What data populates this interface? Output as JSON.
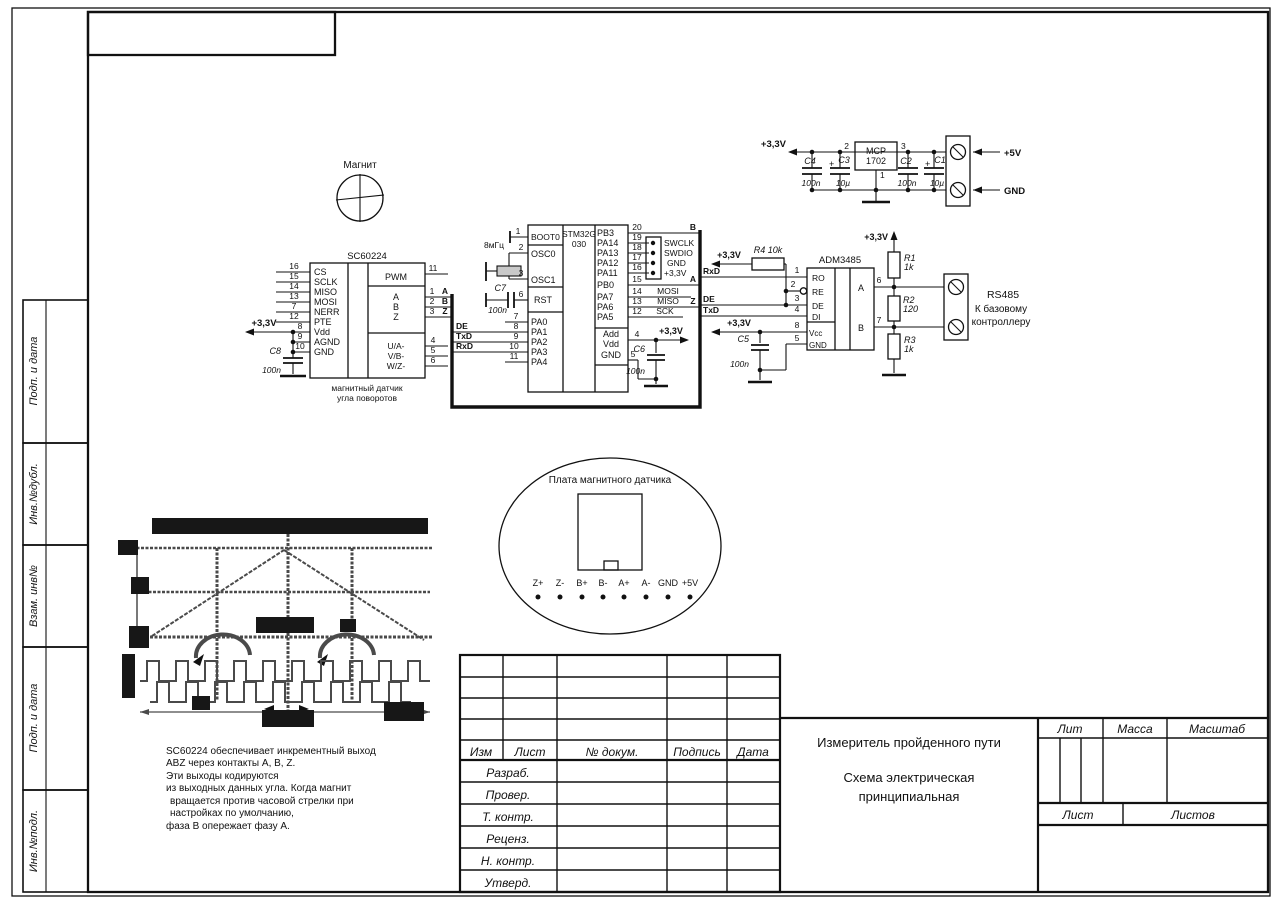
{
  "sheet": {
    "margin_labels": [
      "Подп. и дата",
      "Инв.№дубл.",
      "Взам. инв№",
      "Подп. и дата",
      "Инв.№подл."
    ]
  },
  "power": {
    "v33": "+3,3V",
    "c4": "C4",
    "c4_val": "100n",
    "c3": "C3",
    "c3_plus": "+",
    "c3_val": "10µ",
    "reg_line1": "MCP",
    "reg_line2": "1702",
    "pin2": "2",
    "pin3": "3",
    "pin1": "1",
    "c2": "C2",
    "c2_val": "100n",
    "c1": "C1",
    "c1_plus": "+",
    "c1_val": "10µ",
    "v5": "+5V",
    "gnd": "GND"
  },
  "magnet": {
    "label": "Магнит"
  },
  "sc": {
    "title": "SC60224",
    "left_pins": [
      {
        "n": "16",
        "t": "CS"
      },
      {
        "n": "15",
        "t": "SCLK"
      },
      {
        "n": "14",
        "t": "MISO"
      },
      {
        "n": "13",
        "t": "MOSI"
      },
      {
        "n": "7",
        "t": "NERR"
      },
      {
        "n": "12",
        "t": "PTE"
      },
      {
        "n": "8",
        "t": "Vdd"
      },
      {
        "n": "9",
        "t": "AGND"
      },
      {
        "n": "10",
        "t": "GND"
      }
    ],
    "right_pins": [
      {
        "n": "11",
        "t": "PWM"
      },
      {
        "n": "1",
        "t": "A"
      },
      {
        "n": "2",
        "t": "B"
      },
      {
        "n": "3",
        "t": "Z"
      },
      {
        "n": "4",
        "t": "U/A-"
      },
      {
        "n": "5",
        "t": "V/B-"
      },
      {
        "n": "6",
        "t": "W/Z-"
      }
    ],
    "v33": "+3,3V",
    "c8": "C8",
    "c8_val": "100n",
    "caption1": "магнитный датчик",
    "caption2": "угла поворотов"
  },
  "mcu": {
    "in_a": "A",
    "in_b": "B",
    "in_z": "Z",
    "de": "DE",
    "txd": "TxD",
    "rxd": "RxD",
    "xtal": "8мГц",
    "c7": "C7",
    "c7_val": "100n",
    "name1": "STM32G",
    "name2": "030",
    "left_pins": [
      {
        "n": "1",
        "t": "BOOT0"
      },
      {
        "n": "2",
        "t": "OSC0"
      },
      {
        "n": "3",
        "t": "OSC1"
      },
      {
        "n": "6",
        "t": "RST"
      },
      {
        "n": "7",
        "t": "PA0"
      },
      {
        "n": "8",
        "t": "PA1"
      },
      {
        "n": "9",
        "t": "PA2"
      },
      {
        "n": "10",
        "t": "PA3"
      },
      {
        "n": "11",
        "t": "PA4"
      }
    ],
    "right_pins": [
      {
        "n": "20",
        "t": "PB3"
      },
      {
        "n": "19",
        "t": "PA14"
      },
      {
        "n": "18",
        "t": "PA13"
      },
      {
        "n": "17",
        "t": "PA12"
      },
      {
        "n": "16",
        "t": "PA11"
      },
      {
        "n": "15",
        "t": "PB0"
      },
      {
        "n": "14",
        "t": "PA7"
      },
      {
        "n": "13",
        "t": "PA6"
      },
      {
        "n": "12",
        "t": "PA5"
      }
    ],
    "swd": [
      "SWCLK",
      "SWDIO",
      "GND",
      "+3,3V"
    ],
    "mosi": "MOSI",
    "miso": "MISO",
    "sck": "SCK",
    "out_b": "B",
    "out_a": "A",
    "out_z": "Z",
    "pwr_pins": [
      "Add",
      "Vdd",
      "GND"
    ],
    "pin4": "4",
    "pin5": "5",
    "v33": "+3,3V",
    "c6": "C6",
    "c6_val": "100n",
    "out_rxd": "RxD",
    "out_de": "DE",
    "out_txd": "TxD"
  },
  "adm": {
    "title": "ADM3485",
    "r4": "R4 10k",
    "v33_r4": "+3,3V",
    "pin_nums_left": [
      "1",
      "2",
      "3",
      "4"
    ],
    "pin_names_left": [
      "RO",
      "RE",
      "DE",
      "DI"
    ],
    "vcc": "Vcc",
    "gnd": "GND",
    "pin8": "8",
    "pin5": "5",
    "a": "A",
    "b": "B",
    "pin6": "6",
    "pin7": "7",
    "v33_vcc": "+3,3V",
    "c5": "C5",
    "c5_val": "100n",
    "v33_r1": "+3,3V",
    "r1": "R1",
    "r1_val": "1k",
    "r2": "R2",
    "r2_val": "120",
    "r3": "R3",
    "r3_val": "1k",
    "rs485": "RS485",
    "dest1": "К базовому",
    "dest2": "контроллеру"
  },
  "sensor_board": {
    "title": "Плата магнитного датчика",
    "pins": [
      "Z+",
      "Z-",
      "B+",
      "B-",
      "A+",
      "A-",
      "GND",
      "+5V"
    ]
  },
  "note": {
    "line1": "SC60224 обеспечивает инкрементный выход",
    "line2": "ABZ через контакты A, B, Z.",
    "line3": "Эти выходы кодируются",
    "line4": "из выходных данных угла. Когда магнит",
    "line5": "вращается против часовой стрелки при",
    "line6": "настройках по умолчанию,",
    "line7": "фаза B опережает фазу A."
  },
  "title_block": {
    "col_izm": "Изм",
    "col_list": "Лист",
    "col_dokum": "№ докум.",
    "col_podpis": "Подпись",
    "col_data": "Дата",
    "row1": "Разраб.",
    "row2": "Провер.",
    "row3": "Т. контр.",
    "row4": "Реценз.",
    "row5": "Н. контр.",
    "row6": "Утверд.",
    "doc_title": "Измеритель пройденного пути",
    "doc_type1": "Схема электрическая",
    "doc_type2": "принципиальная",
    "lit": "Лит",
    "massa": "Масса",
    "masshtab": "Масштаб",
    "list": "Лист",
    "listov": "Листов"
  }
}
